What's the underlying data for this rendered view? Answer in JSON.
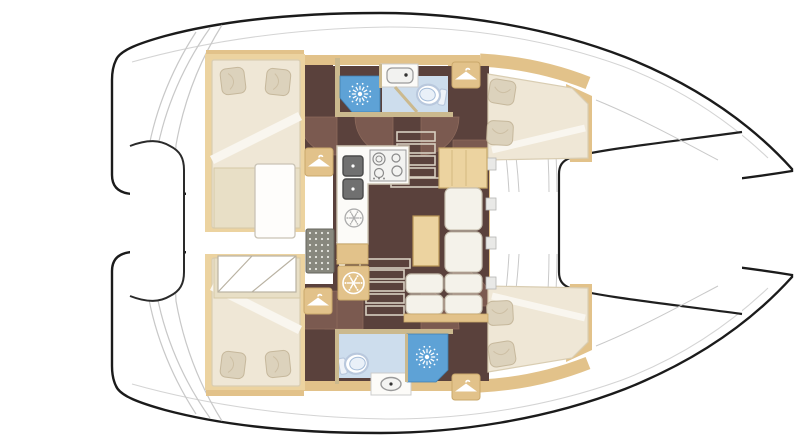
{
  "diagram": {
    "type": "catamaran-interior-floor-plan",
    "orientation": {
      "bow": "right",
      "stern": "left"
    },
    "palette": {
      "hull_outline": "#1b1b1b",
      "deck_white": "#ffffff",
      "line_gray": "#c9c9c9",
      "tan": "#e2c28a",
      "tan_dark": "#c9a96a",
      "tan_light": "#ecd3a0",
      "floor_brown": "#5a413c",
      "door_swing_brown": "#7b5a50",
      "shower_blue": "#5ea2d6",
      "bath_floor_blue": "#cddded",
      "mattress_cream": "#efe7d6",
      "cushion_cream": "#e8dfc6",
      "pillow_beige": "#dcd2bc",
      "sofa_white": "#f4f2ea",
      "counter_white": "#fcfbf8",
      "appliance_gray": "#9a9a9a",
      "sink_dark": "#707070",
      "grate_gray": "#88887e",
      "icon_white": "#ffffff"
    },
    "elements": {
      "double_berths": 4,
      "heads": 2,
      "showers": 2,
      "toilets": 2,
      "bath_sinks": 2,
      "galley_sinks": 2,
      "stove_burners": 4,
      "fridge_snowflake_icons": 2,
      "hanging_locker_icons": 4,
      "companionway_stairs": 2,
      "door_swings": 8,
      "deck_grates": 1,
      "up_down_arrow_markers": 1
    }
  }
}
